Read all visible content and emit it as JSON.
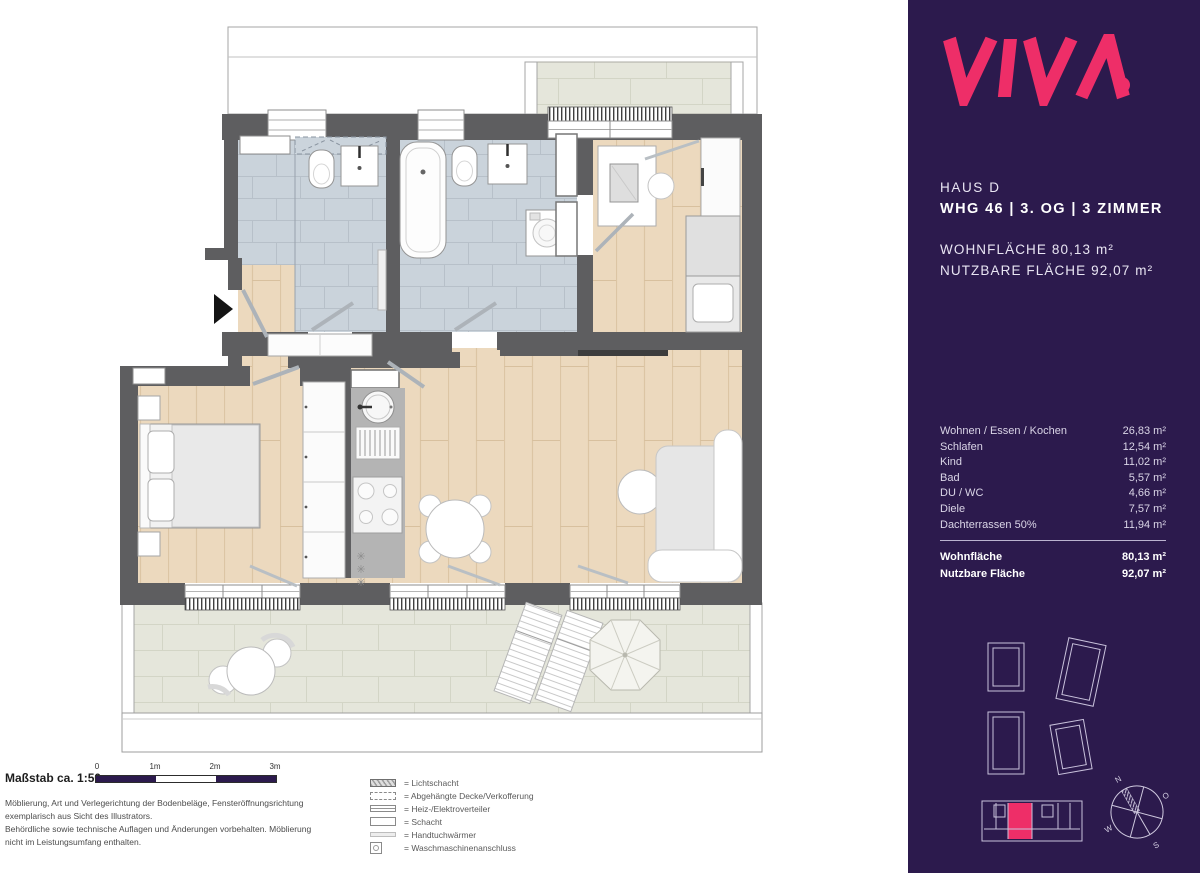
{
  "sidebar": {
    "logo": "VIVA",
    "haus": "HAUS D",
    "unit_line": "WHG 46 | 3. OG | 3 ZIMMER",
    "area_line1": "WOHNFLÄCHE 80,13 m²",
    "area_line2": "NUTZBARE FLÄCHE 92,07 m²",
    "rooms": [
      {
        "label": "Wohnen / Essen / Kochen",
        "value": "26,83 m²"
      },
      {
        "label": "Schlafen",
        "value": "12,54 m²"
      },
      {
        "label": "Kind",
        "value": "11,02 m²"
      },
      {
        "label": "Bad",
        "value": "5,57 m²"
      },
      {
        "label": "DU / WC",
        "value": "4,66 m²"
      },
      {
        "label": "Diele",
        "value": "7,57 m²"
      },
      {
        "label": "Dachterrassen 50%",
        "value": "11,94 m²"
      }
    ],
    "totals": [
      {
        "label": "Wohnfläche",
        "value": "80,13 m²"
      },
      {
        "label": "Nutzbare Fläche",
        "value": "92,07 m²"
      }
    ],
    "compass": {
      "n": "N",
      "o": "O",
      "s": "S",
      "w": "W"
    }
  },
  "footer": {
    "scale_label": "Maßstab ca. 1:50",
    "scale_ticks": [
      "0",
      "1m",
      "2m",
      "3m"
    ],
    "disclaimer_lines": [
      "Möblierung, Art und Verlegerichtung der Bodenbeläge, Fensteröffnungsrichtung",
      "exemplarisch aus Sicht des Illustrators.",
      "Behördliche sowie technische Auflagen und Änderungen vorbehalten. Möblierung",
      "nicht im Leistungsumfang enthalten."
    ],
    "legend": [
      {
        "icon": "lichtschacht-icon",
        "label": "= Lichtschacht"
      },
      {
        "icon": "abgehaengte-decke-icon",
        "label": "= Abgehängte Decke/Verkofferung"
      },
      {
        "icon": "heiz-elektro-icon",
        "label": "= Heiz-/Elektroverteiler"
      },
      {
        "icon": "schacht-icon",
        "label": "= Schacht"
      },
      {
        "icon": "handtuchwaermer-icon",
        "label": "= Handtuchwärmer"
      },
      {
        "icon": "waschmaschine-icon",
        "label": "= Waschmaschinenanschluss"
      }
    ]
  },
  "colors": {
    "brand_pink": "#EE2E68",
    "sidebar_bg": "#2C1A4D",
    "wall_gray": "#5E5E60",
    "wood_floor": "#ECD9BE",
    "bath_tile": "#CAD3DB",
    "terrace_tile": "#E5E6DB"
  }
}
